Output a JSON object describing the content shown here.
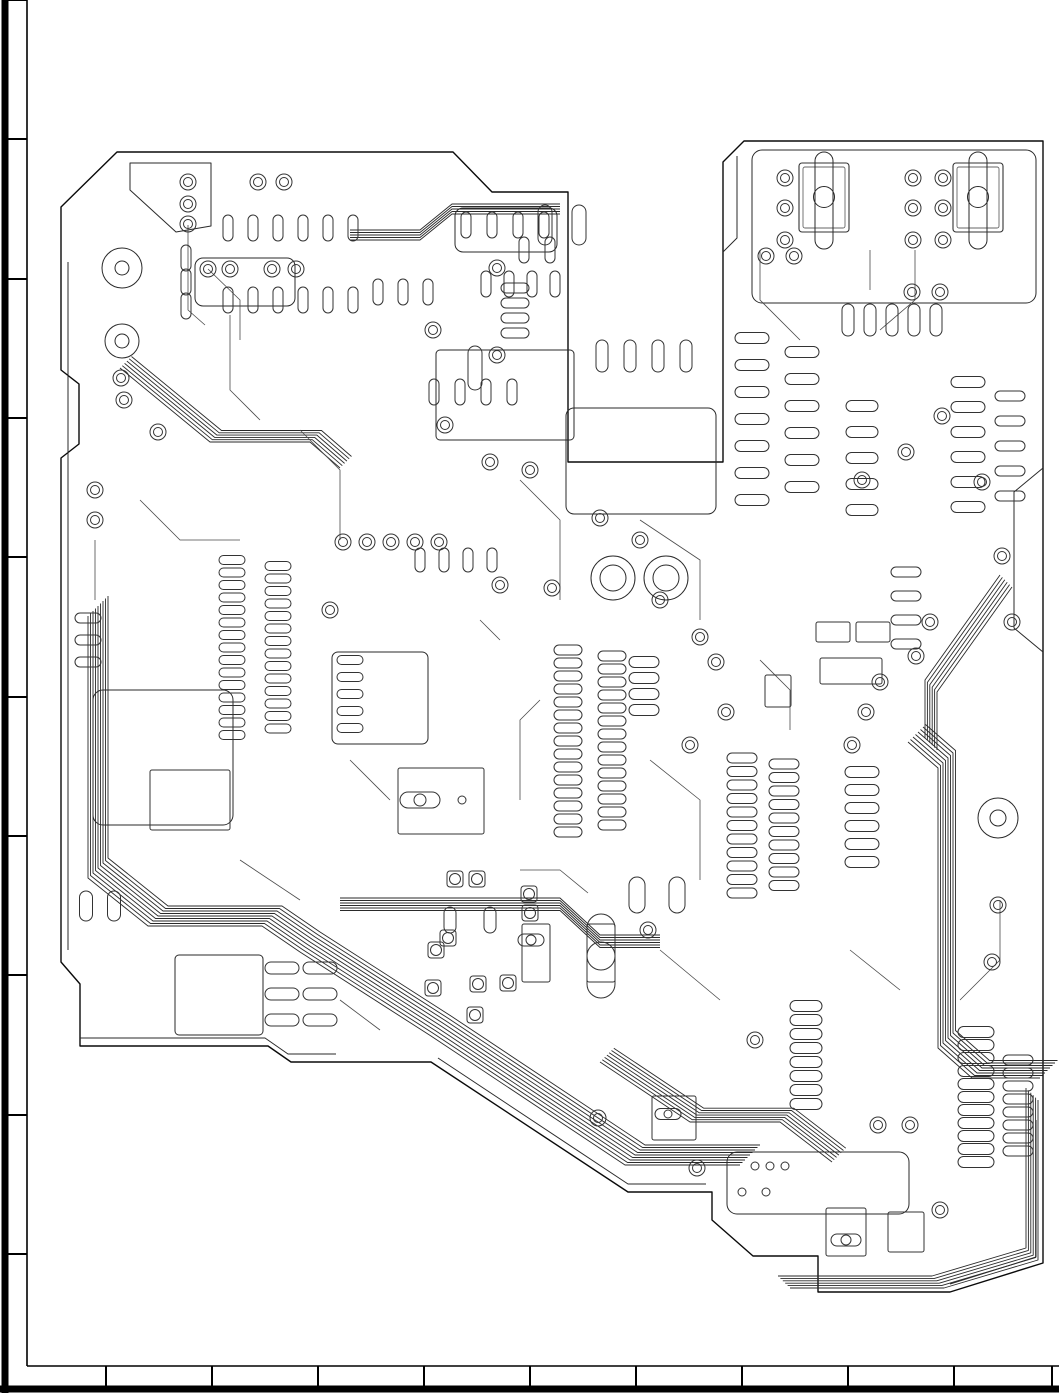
{
  "meta": {
    "drawing_type": "pcb-copper-layout",
    "canvas": {
      "width": 1059,
      "height": 1393
    },
    "colors": {
      "background": "#ffffff",
      "frame": "#000000",
      "outline": "#0a0a0a",
      "copper": "#2a2a2a",
      "pad": "#333333",
      "trace": "#4a4a4a",
      "light": "#666666"
    }
  },
  "frame": {
    "left": {
      "outer_x": 5,
      "outer_w": 7,
      "inner_x": 27,
      "tick_ys": [
        0,
        139,
        279,
        418,
        557,
        697,
        836,
        975,
        1115,
        1254
      ]
    },
    "bottom": {
      "outer_y": 1389,
      "outer_h": 7,
      "inner_y": 1366,
      "tick_xs": [
        106,
        212,
        318,
        424,
        530,
        636,
        742,
        848,
        954,
        1052
      ]
    }
  },
  "board": {
    "outline": "M117,152 L61,207 L61,370 L79,384 L79,444 L61,458 L61,962 L80,984 L80,1046 L268,1046 L291,1062 L431,1062 L628,1192 L712,1192 L712,1220 L753,1256 L818,1256 L818,1292 L950,1292 L1043,1263 L1043,141 L744,141 L723,162 L723,462 L568,462 L568,192 L492,192 L453,152 Z",
    "pour_lines": [
      "M68,262 V950",
      "M80,1038 H265 L288,1054 H336",
      "M1043,468 L1014,492 V628 L1043,652",
      "M737,156 V238 L723,252",
      "M438,1058 L628,1184 H706",
      "M950,1284 L1036,1257 V1120",
      "M130,163 H211 V226 L176,232 L130,190 Z"
    ],
    "zones": [
      {
        "x": 195,
        "y": 258,
        "w": 100,
        "h": 48,
        "r": 8
      },
      {
        "x": 752,
        "y": 150,
        "w": 284,
        "h": 153,
        "r": 10
      },
      {
        "x": 566,
        "y": 408,
        "w": 150,
        "h": 106,
        "r": 8
      },
      {
        "x": 175,
        "y": 955,
        "w": 88,
        "h": 80,
        "r": 4
      },
      {
        "x": 727,
        "y": 1152,
        "w": 182,
        "h": 62,
        "r": 10
      },
      {
        "x": 93,
        "y": 690,
        "w": 140,
        "h": 135,
        "r": 10
      },
      {
        "x": 332,
        "y": 652,
        "w": 96,
        "h": 92,
        "r": 6
      },
      {
        "x": 436,
        "y": 350,
        "w": 138,
        "h": 90,
        "r": 4
      },
      {
        "x": 455,
        "y": 208,
        "w": 102,
        "h": 44,
        "r": 8
      }
    ],
    "mount_holes": [
      {
        "x": 122,
        "y": 268,
        "r1": 20,
        "r2": 7
      },
      {
        "x": 122,
        "y": 341,
        "r1": 17,
        "r2": 7
      },
      {
        "x": 998,
        "y": 818,
        "r1": 20,
        "r2": 8
      },
      {
        "x": 613,
        "y": 578,
        "r1": 22,
        "r2": 13
      },
      {
        "x": 666,
        "y": 578,
        "r1": 22,
        "r2": 13
      }
    ],
    "connectors": [
      {
        "x": 799,
        "y": 163,
        "w": 50,
        "h": 69
      },
      {
        "x": 953,
        "y": 163,
        "w": 50,
        "h": 69
      }
    ],
    "component_rects": [
      {
        "x": 398,
        "y": 768,
        "w": 86,
        "h": 66
      },
      {
        "x": 522,
        "y": 924,
        "w": 28,
        "h": 58
      },
      {
        "x": 587,
        "y": 924,
        "w": 28,
        "h": 58
      },
      {
        "x": 150,
        "y": 770,
        "w": 80,
        "h": 60
      },
      {
        "x": 652,
        "y": 1096,
        "w": 44,
        "h": 44
      },
      {
        "x": 826,
        "y": 1208,
        "w": 40,
        "h": 48
      },
      {
        "x": 888,
        "y": 1212,
        "w": 36,
        "h": 40
      },
      {
        "x": 765,
        "y": 675,
        "w": 26,
        "h": 32
      },
      {
        "x": 816,
        "y": 622,
        "w": 34,
        "h": 20
      },
      {
        "x": 856,
        "y": 622,
        "w": 34,
        "h": 20
      },
      {
        "x": 820,
        "y": 658,
        "w": 62,
        "h": 26
      }
    ],
    "big_pads": [
      {
        "x": 601,
        "y": 956,
        "w": 28,
        "h": 84,
        "cr": 14
      },
      {
        "x": 420,
        "y": 800,
        "w": 40,
        "h": 16,
        "cr": 6
      },
      {
        "x": 531,
        "y": 940,
        "w": 26,
        "h": 12,
        "cr": 5
      },
      {
        "x": 846,
        "y": 1240,
        "w": 30,
        "h": 12,
        "cr": 5
      },
      {
        "x": 668,
        "y": 1114,
        "w": 26,
        "h": 11,
        "cr": 4
      }
    ],
    "pin_rows": [
      {
        "x": 232,
        "y": 560,
        "n": 15,
        "p": 12.5,
        "dir": "v",
        "w": 26,
        "h": 9
      },
      {
        "x": 278,
        "y": 566,
        "n": 14,
        "p": 12.5,
        "dir": "v",
        "w": 26,
        "h": 9
      },
      {
        "x": 568,
        "y": 650,
        "n": 15,
        "p": 13,
        "dir": "v",
        "w": 28,
        "h": 10
      },
      {
        "x": 612,
        "y": 656,
        "n": 14,
        "p": 13,
        "dir": "v",
        "w": 28,
        "h": 10
      },
      {
        "x": 742,
        "y": 758,
        "n": 11,
        "p": 13.5,
        "dir": "v",
        "w": 30,
        "h": 10
      },
      {
        "x": 784,
        "y": 764,
        "n": 10,
        "p": 13.5,
        "dir": "v",
        "w": 30,
        "h": 10
      },
      {
        "x": 862,
        "y": 772,
        "n": 6,
        "p": 18,
        "dir": "v",
        "w": 34,
        "h": 11
      },
      {
        "x": 976,
        "y": 1032,
        "n": 11,
        "p": 13,
        "dir": "v",
        "w": 36,
        "h": 11
      },
      {
        "x": 1018,
        "y": 1060,
        "n": 8,
        "p": 13,
        "dir": "v",
        "w": 30,
        "h": 10
      },
      {
        "x": 806,
        "y": 1006,
        "n": 8,
        "p": 14,
        "dir": "v",
        "w": 32,
        "h": 11
      },
      {
        "x": 228,
        "y": 228,
        "n": 6,
        "p": 25,
        "dir": "h",
        "w": 10,
        "h": 26
      },
      {
        "x": 228,
        "y": 300,
        "n": 6,
        "p": 25,
        "dir": "h",
        "w": 10,
        "h": 26
      },
      {
        "x": 378,
        "y": 292,
        "n": 3,
        "p": 25,
        "dir": "h",
        "w": 10,
        "h": 26
      },
      {
        "x": 466,
        "y": 225,
        "n": 4,
        "p": 26,
        "dir": "h",
        "w": 10,
        "h": 26
      },
      {
        "x": 486,
        "y": 284,
        "n": 4,
        "p": 23,
        "dir": "h",
        "w": 10,
        "h": 26
      },
      {
        "x": 434,
        "y": 392,
        "n": 4,
        "p": 26,
        "dir": "h",
        "w": 10,
        "h": 26
      },
      {
        "x": 848,
        "y": 320,
        "n": 5,
        "p": 22,
        "dir": "h",
        "w": 12,
        "h": 32
      },
      {
        "x": 602,
        "y": 356,
        "n": 4,
        "p": 28,
        "dir": "h",
        "w": 12,
        "h": 32
      },
      {
        "x": 752,
        "y": 338,
        "n": 7,
        "p": 27,
        "dir": "v",
        "w": 34,
        "h": 11
      },
      {
        "x": 802,
        "y": 352,
        "n": 6,
        "p": 27,
        "dir": "v",
        "w": 34,
        "h": 11
      },
      {
        "x": 968,
        "y": 382,
        "n": 6,
        "p": 25,
        "dir": "v",
        "w": 34,
        "h": 11
      },
      {
        "x": 1010,
        "y": 396,
        "n": 5,
        "p": 25,
        "dir": "v",
        "w": 30,
        "h": 10
      },
      {
        "x": 862,
        "y": 406,
        "n": 5,
        "p": 26,
        "dir": "v",
        "w": 32,
        "h": 11
      },
      {
        "x": 86,
        "y": 906,
        "n": 2,
        "p": 28,
        "dir": "h",
        "w": 13,
        "h": 30
      },
      {
        "x": 282,
        "y": 968,
        "n": 2,
        "p": 38,
        "dir": "h",
        "w": 34,
        "h": 12
      },
      {
        "x": 282,
        "y": 994,
        "n": 2,
        "p": 38,
        "dir": "h",
        "w": 34,
        "h": 12
      },
      {
        "x": 282,
        "y": 1020,
        "n": 2,
        "p": 38,
        "dir": "h",
        "w": 34,
        "h": 12
      },
      {
        "x": 644,
        "y": 662,
        "n": 4,
        "p": 16,
        "dir": "v",
        "w": 30,
        "h": 11
      },
      {
        "x": 637,
        "y": 895,
        "n": 2,
        "p": 40,
        "dir": "h",
        "w": 16,
        "h": 36
      },
      {
        "x": 450,
        "y": 920,
        "n": 2,
        "p": 40,
        "dir": "h",
        "w": 12,
        "h": 26
      },
      {
        "x": 524,
        "y": 250,
        "n": 2,
        "p": 26,
        "dir": "h",
        "w": 10,
        "h": 26
      },
      {
        "x": 186,
        "y": 258,
        "n": 3,
        "p": 24,
        "dir": "v",
        "w": 10,
        "h": 26
      },
      {
        "x": 906,
        "y": 572,
        "n": 4,
        "p": 24,
        "dir": "v",
        "w": 30,
        "h": 10
      },
      {
        "x": 350,
        "y": 660,
        "n": 5,
        "p": 17,
        "dir": "v",
        "w": 26,
        "h": 9
      },
      {
        "x": 420,
        "y": 560,
        "n": 4,
        "p": 24,
        "dir": "h",
        "w": 10,
        "h": 24
      },
      {
        "x": 88,
        "y": 618,
        "n": 3,
        "p": 22,
        "dir": "v",
        "w": 26,
        "h": 10
      },
      {
        "x": 515,
        "y": 288,
        "n": 4,
        "p": 15,
        "dir": "v",
        "w": 28,
        "h": 10
      },
      {
        "x": 545,
        "y": 225,
        "n": 2,
        "p": 34,
        "dir": "h",
        "w": 14,
        "h": 40
      },
      {
        "x": 475,
        "y": 368,
        "n": 1,
        "p": 20,
        "dir": "v",
        "w": 14,
        "h": 44
      }
    ],
    "vias": [
      [
        188,
        182
      ],
      [
        188,
        204
      ],
      [
        188,
        224
      ],
      [
        208,
        269
      ],
      [
        230,
        269
      ],
      [
        272,
        269
      ],
      [
        296,
        269
      ],
      [
        121,
        378
      ],
      [
        124,
        400
      ],
      [
        158,
        432
      ],
      [
        258,
        182
      ],
      [
        284,
        182
      ],
      [
        343,
        542
      ],
      [
        367,
        542
      ],
      [
        391,
        542
      ],
      [
        415,
        542
      ],
      [
        439,
        542
      ],
      [
        552,
        588
      ],
      [
        500,
        585
      ],
      [
        445,
        425
      ],
      [
        490,
        462
      ],
      [
        530,
        470
      ],
      [
        330,
        610
      ],
      [
        95,
        490
      ],
      [
        95,
        520
      ],
      [
        660,
        600
      ],
      [
        700,
        637
      ],
      [
        690,
        745
      ],
      [
        716,
        662
      ],
      [
        726,
        712
      ],
      [
        852,
        745
      ],
      [
        866,
        712
      ],
      [
        880,
        682
      ],
      [
        916,
        656
      ],
      [
        930,
        622
      ],
      [
        862,
        480
      ],
      [
        906,
        452
      ],
      [
        942,
        416
      ],
      [
        982,
        482
      ],
      [
        1002,
        556
      ],
      [
        1012,
        622
      ],
      [
        766,
        256
      ],
      [
        794,
        256
      ],
      [
        785,
        178
      ],
      [
        785,
        208
      ],
      [
        785,
        240
      ],
      [
        913,
        178
      ],
      [
        943,
        178
      ],
      [
        913,
        208
      ],
      [
        943,
        208
      ],
      [
        913,
        240
      ],
      [
        943,
        240
      ],
      [
        912,
        292
      ],
      [
        940,
        292
      ],
      [
        878,
        1125
      ],
      [
        910,
        1125
      ],
      [
        697,
        1168
      ],
      [
        940,
        1210
      ],
      [
        598,
        1118
      ],
      [
        648,
        930
      ],
      [
        998,
        905
      ],
      [
        497,
        268
      ],
      [
        433,
        330
      ],
      [
        497,
        355
      ],
      [
        600,
        518
      ],
      [
        640,
        540
      ],
      [
        755,
        1040
      ],
      [
        992,
        962
      ]
    ],
    "square_pads": [
      [
        455,
        879
      ],
      [
        477,
        879
      ],
      [
        529,
        894
      ],
      [
        530,
        913
      ],
      [
        436,
        950
      ],
      [
        478,
        984
      ],
      [
        433,
        988
      ],
      [
        508,
        983
      ],
      [
        475,
        1015
      ],
      [
        448,
        938
      ]
    ],
    "small_circles": [
      [
        755,
        1166
      ],
      [
        770,
        1166
      ],
      [
        785,
        1166
      ],
      [
        742,
        1192
      ],
      [
        766,
        1192
      ],
      [
        462,
        800
      ]
    ],
    "bundles": [
      {
        "d": "M88,616 V878 L148,926 H262 L300,952 L431,1036 L625,1165 H740",
        "n": 9,
        "ox": 2.5,
        "oy": -2.5
      },
      {
        "d": "M908,742 L938,768 V1048 L972,1078 H1040",
        "n": 8,
        "ox": 2.5,
        "oy": -2.5
      },
      {
        "d": "M120,368 L210,442 H310 L340,468",
        "n": 6,
        "ox": 2.3,
        "oy": -2.3
      },
      {
        "d": "M340,898 H560 L600,935 H660",
        "n": 6,
        "ox": 0,
        "oy": 2.5
      },
      {
        "d": "M350,230 H420 L452,204 H560",
        "n": 5,
        "ox": 0,
        "oy": 2.5
      },
      {
        "d": "M790,1288 H944 L1038,1260 V1100",
        "n": 6,
        "ox": -2.4,
        "oy": -2.4
      },
      {
        "d": "M600,1062 L690,1122 H780 L832,1162",
        "n": 7,
        "ox": 2.3,
        "oy": -2.3
      },
      {
        "d": "M1000,575 L925,680 V738",
        "n": 6,
        "ox": 2.4,
        "oy": 2.4
      }
    ],
    "traces": [
      "M188,225 L188,310 L205,325",
      "M230,315 L230,390 L260,420",
      "M300,430 L340,470 L340,540",
      "M520,480 L560,520 L560,600",
      "M640,520 L700,560 L700,620",
      "M760,250 L760,300 L800,340",
      "M870,250 L870,290",
      "M915,250 L915,300 L880,330",
      "M650,760 L700,800 L700,880",
      "M540,700 L520,720 L520,800",
      "M350,760 L390,800",
      "M660,950 L720,1000",
      "M850,950 L900,990",
      "M240,860 L300,900",
      "M140,500 L180,540 L240,540",
      "M95,540 L95,600",
      "M480,620 L500,640",
      "M1000,900 L1000,960 L960,1000",
      "M760,660 L790,690 L790,730",
      "M340,1000 L380,1030",
      "M208,269 L240,300 L240,340",
      "M588,893 L560,870 L520,870"
    ]
  }
}
